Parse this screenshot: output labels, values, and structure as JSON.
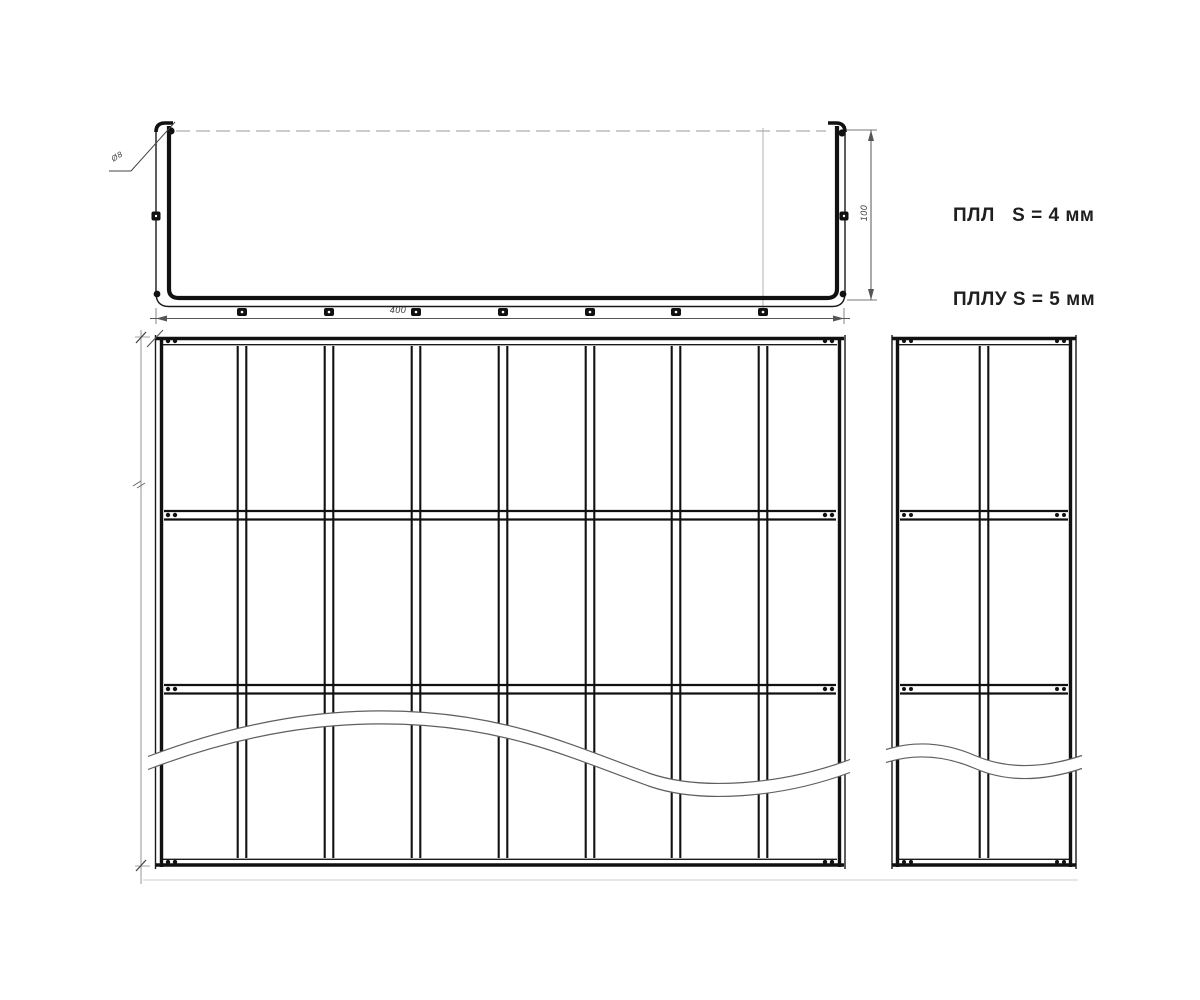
{
  "spec_note": {
    "line1": "ПЛЛ   S = 4 мм",
    "line2": "ПЛЛУ S = 5 мм"
  },
  "dimensions": {
    "tray_width": "400",
    "side_height": "100",
    "leader": "Ø8"
  },
  "colors": {
    "line": "#1a1a1a",
    "dim": "#555555",
    "faint": "#aaaaaa",
    "background": "#ffffff"
  },
  "drawing_structure": {
    "views": [
      {
        "name": "side-elevation",
        "rivets_bottom": 7,
        "wall_bolts_per_side": 2
      },
      {
        "name": "plan-main-grid",
        "vertical_rungs": 7,
        "columns": 8,
        "horizontal_rails": 2,
        "break_line": true
      },
      {
        "name": "plan-side-grid",
        "vertical_rungs": 1,
        "columns": 2,
        "horizontal_rails": 2,
        "break_line": true
      }
    ]
  }
}
